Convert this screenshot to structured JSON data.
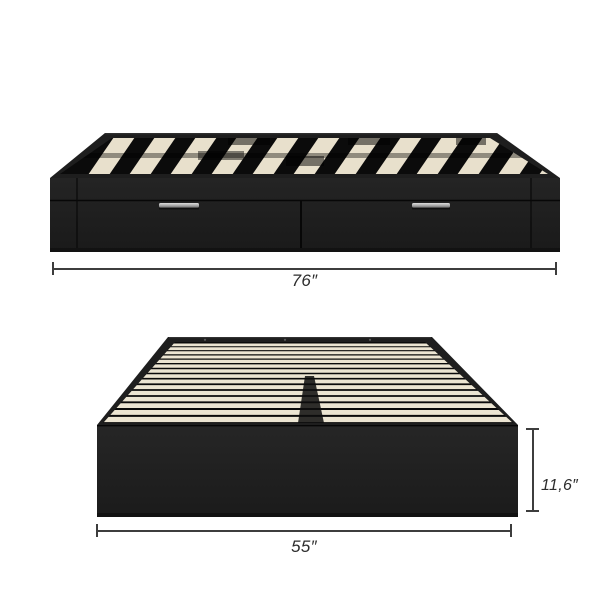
{
  "dimensions": {
    "top_view_width": "76″",
    "bottom_view_width": "55″",
    "bottom_view_height": "11,6″"
  },
  "illustration": {
    "side_view": {
      "slat_count": 13,
      "drawer_count": 2
    },
    "front_view": {
      "slat_count": 15
    }
  },
  "colors": {
    "background": "#ffffff",
    "bed_black": "#1e1e1e",
    "deck_dark": "#0b0b0b",
    "slat_cream": "#e8e0cc",
    "slat_cream_front": "#ece5d2",
    "handle_light": "#dedede",
    "handle_dark": "#6f6f6f",
    "dimension_line": "#3d3d3d",
    "label_text": "#2d2d2d"
  }
}
